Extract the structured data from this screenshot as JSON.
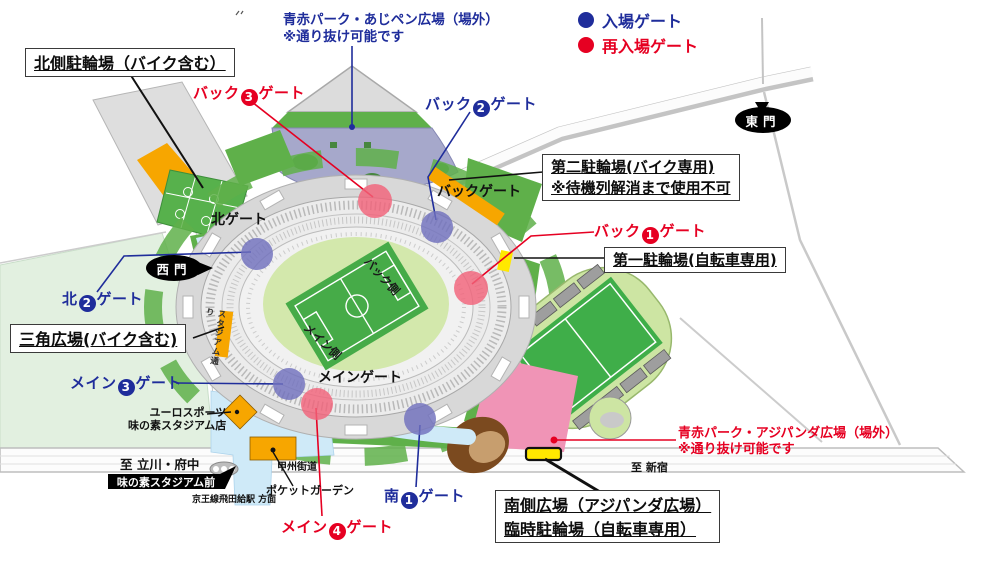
{
  "legend": {
    "entry": {
      "label": "入場ゲート",
      "color": "#1f2d9b"
    },
    "reentry": {
      "label": "再入場ゲート",
      "color": "#e60022"
    }
  },
  "notes": {
    "north": {
      "line1": "青赤パーク・あじペン広場（場外）",
      "line2": "※通り抜け可能です"
    },
    "south": {
      "line1": "青赤パーク・アジパンダ広場（場外）",
      "line2": "※通り抜け可能です"
    }
  },
  "boxes": {
    "north_bike": {
      "line1": "北側駐輪場（バイク含む）"
    },
    "second_bike": {
      "line1": "第二駐輪場(バイク専用)",
      "line2": "※待機列解消まで使用不可"
    },
    "first_bicycle": {
      "line1": "第一駐輪場(自転車専用)"
    },
    "triangle": {
      "line1": "三角広場(バイク含む)"
    },
    "south_plaza": {
      "line1": "南側広場（アジパンダ広場）",
      "line2": "臨時駐輪場（自転車専用）"
    }
  },
  "gates": {
    "back3": {
      "prefix": "バック",
      "number": "3",
      "suffix": "ゲート"
    },
    "back2": {
      "prefix": "バック",
      "number": "2",
      "suffix": "ゲート"
    },
    "back1": {
      "prefix": "バック",
      "number": "1",
      "suffix": "ゲート"
    },
    "north2": {
      "prefix": "北",
      "number": "2",
      "suffix": "ゲート"
    },
    "main3": {
      "prefix": "メイン",
      "number": "3",
      "suffix": "ゲート"
    },
    "main4": {
      "prefix": "メイン",
      "number": "4",
      "suffix": "ゲート"
    },
    "south1": {
      "prefix": "南",
      "number": "1",
      "suffix": "ゲート"
    },
    "back_plain": "バックゲート",
    "north_plain": "北ゲート",
    "main_plain": "メインゲート"
  },
  "places": {
    "east_gate": "東門",
    "west_gate": "西門",
    "euro1": "ユーロスポーツ",
    "euro2": "味の素スタジアム店",
    "to_tachikawa": "至 立川・府中",
    "bus_stop": "味の素スタジアム前",
    "keio": "京王線飛田給駅 方面",
    "koshu": "甲州街道",
    "pocket": "ポケットガーデン",
    "to_shinjuku": "至 新宿",
    "stadium_street": "スタジアム通り",
    "back_side": "バック側",
    "main_side": "メイン側"
  },
  "colors": {
    "entry_gate": "#1f2d9b",
    "reentry_gate": "#e60022",
    "parking_orange": "#f7a600",
    "highlight_yellow": "#ffe800",
    "plaza_pink": "#f094b6",
    "plaza_purple": "#a6a8cb",
    "walkway_blue": "#cfeaf8",
    "pitch_green": "#46ab48",
    "lawn_green": "#5fb04a",
    "pale_green": "#e2f0e0"
  }
}
